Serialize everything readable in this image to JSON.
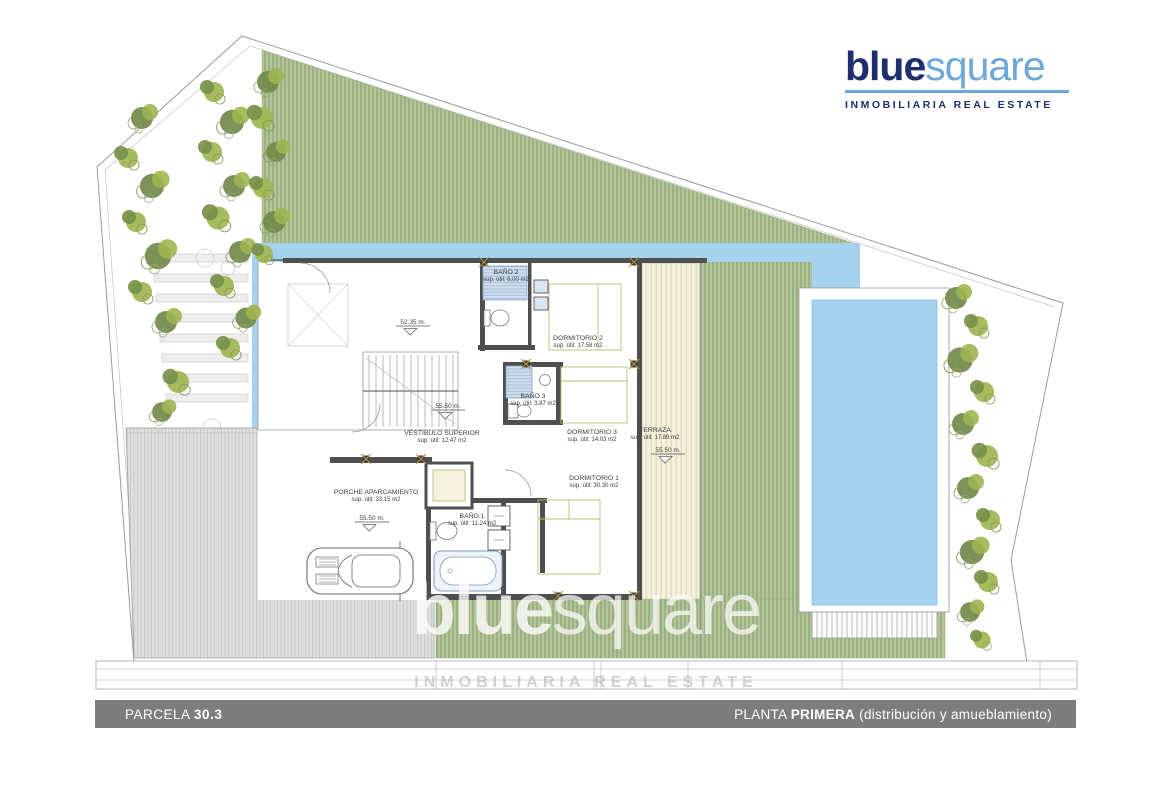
{
  "logo": {
    "blue": "blue",
    "square": "square",
    "tagline": "INMOBILIARIA REAL ESTATE"
  },
  "watermark": {
    "blue": "blue",
    "square": "square",
    "tagline": "INMOBILIARIA REAL ESTATE"
  },
  "footer": {
    "parcel_label": "PARCELA",
    "parcel_value": "30.3",
    "floor_label": "PLANTA",
    "floor_value": "PRIMERA",
    "floor_note": "(distribución y amueblamiento)"
  },
  "rooms": [
    {
      "name": "BAÑO 2",
      "area": "sup. útil: 6.00 m2"
    },
    {
      "name": "DORMITORIO 2",
      "area": "sup. útil: 17.58 m2"
    },
    {
      "name": "BAÑO 3",
      "area": "sup. útil: 3.87 m2"
    },
    {
      "name": "DORMITORIO 3",
      "area": "sup. útil: 14.03 m2"
    },
    {
      "name": "TERRAZA",
      "area": "sup. útil: 17.89 m2"
    },
    {
      "name": "VESTIBULO SUPERIOR",
      "area": "sup. útil: 12.47 m2"
    },
    {
      "name": "DORMITORIO 1",
      "area": "sup. útil: 30.30 m2"
    },
    {
      "name": "BAÑO 1",
      "area": "sup. útil: 11.24 m2"
    },
    {
      "name": "PORCHE APARCAMIENTO",
      "area": "sup. útil: 33.15 m2"
    }
  ],
  "levels": [
    {
      "value": "52.35 m."
    },
    {
      "value": "55.50 m."
    },
    {
      "value": "55.50 m."
    },
    {
      "value": "55.50 m."
    }
  ],
  "colors": {
    "brand_navy": "#1d2f6d",
    "brand_lightblue": "#6ea8d8",
    "lawn_green": "#b5c49c",
    "pool_blue": "#a5d2ee",
    "wall_gray": "#4f4f4f",
    "footer_gray": "#7d7d7d"
  }
}
